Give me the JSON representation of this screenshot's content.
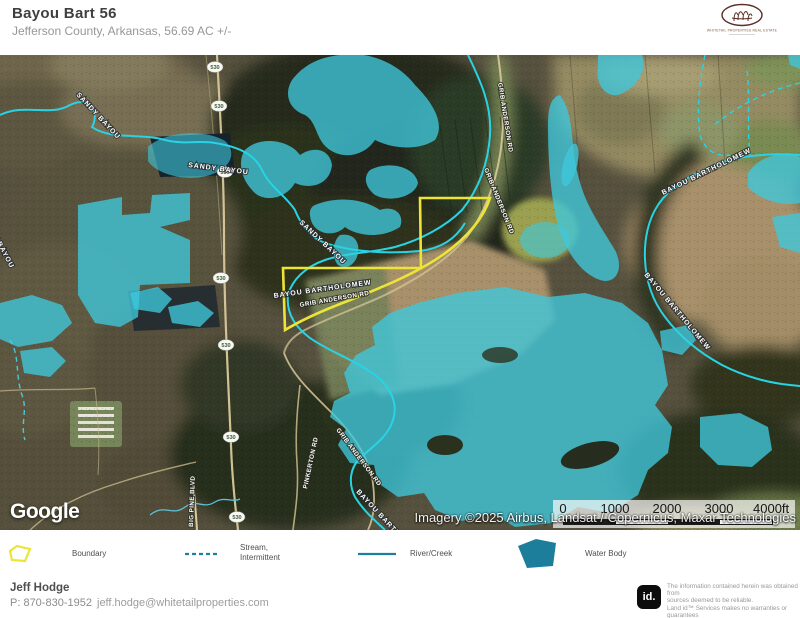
{
  "header": {
    "title": "Bayou Bart 56",
    "subtitle": "Jefferson County, Arkansas, 56.69 AC +/-",
    "brand_line": "WHITETAIL PROPERTIES REAL ESTATE"
  },
  "map": {
    "google_logo": "Google",
    "attribution": "Imagery ©2025 Airbus, Landsat / Copernicus, Maxar Technologies",
    "highway_shield": "530",
    "scale_bar": {
      "ticks": [
        "0",
        "1000",
        "2000",
        "3000",
        "4000ft"
      ]
    },
    "labels": {
      "grib_anderson_rd": "GRIB ANDERSON RD",
      "pinkerton_rd": "PINKERTON RD",
      "big_pine_blvd": "BIG PINE BLVD",
      "sandy_bayou": "SANDY BAYOU",
      "bayou_bartholomew": "BAYOU BARTHOLOMEW"
    }
  },
  "legend": {
    "boundary": "Boundary",
    "stream_line1": "Stream,",
    "stream_line2": "Intermittent",
    "river": "River/Creek",
    "water_body": "Water Body"
  },
  "footer": {
    "agent": "Jeff Hodge",
    "phone": "P: 870-830-1952",
    "email": "jeff.hodge@whitetailproperties.com",
    "landid_logo": "id.",
    "disclaimer_line1": "The information contained herein was obtained from",
    "disclaimer_line2": "sources deemed to be reliable.",
    "disclaimer_line3": " Land id™ Services makes no warranties or guarantees",
    "disclaimer_line4": "as to the completeness or accuracy thereof."
  },
  "colors": {
    "boundary_yellow": "#ece437",
    "water_overlay_cyan": "#3fc8dc",
    "stream_cyan": "#29d3e4",
    "legend_teal": "#1d7f9e",
    "brand_maroon": "#5a3029"
  }
}
